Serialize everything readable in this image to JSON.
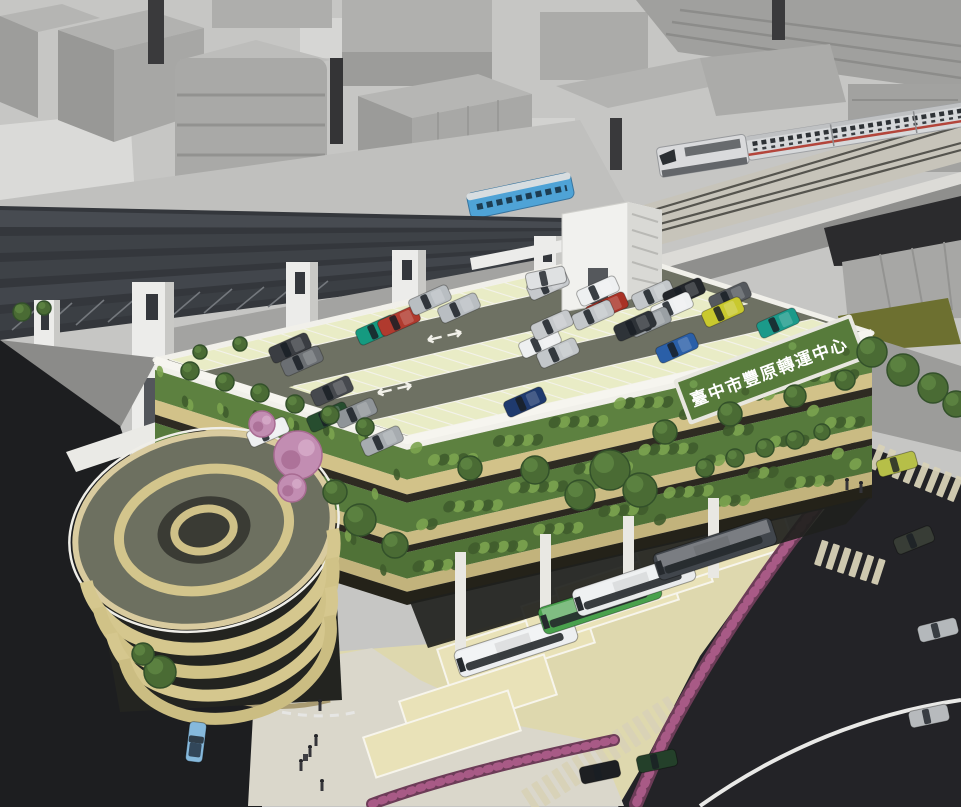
{
  "image": {
    "width": 961,
    "height": 807,
    "kind": "architectural-aerial-rendering",
    "subject": "transit-center-parking-building"
  },
  "sign": {
    "text": "臺中市豐原轉運中心",
    "text_color": "#ffffff",
    "panel_color": "#577b3b",
    "frame_color": "#e8e7e0"
  },
  "palette": {
    "city_block": "#b3b3b1",
    "canopy_roof": "#3e4247",
    "pylon": "#ececea",
    "ballast": "#c7c4ba",
    "intercity_train_body": "#d6d8da",
    "intercity_train_stripe": "#b3453b",
    "commuter_train_body": "#4fa3d6",
    "deck": "#6e7163",
    "deck_stall": "#e9ecc6",
    "parapet": "#f1f0ea",
    "bamboo_screen": "#d2c289",
    "foliage": "#5d8140",
    "bus_apron": "#ded8ae",
    "road": "#232327",
    "road_line": "#e9e9e7",
    "sidewalk": "#dad7cb",
    "hedge": "#6d3c58",
    "hedge_flower": "#a85a86",
    "ramp_band": "#d5c78e"
  },
  "deck": {
    "bands": [
      {
        "y0": 0.02,
        "y1": 0.16,
        "x0": 0.02,
        "x1": 0.98,
        "step": 0.048
      },
      {
        "y0": 0.42,
        "y1": 0.58,
        "x0": 0.07,
        "x1": 0.96,
        "step": 0.05
      },
      {
        "y0": 0.8,
        "y1": 0.97,
        "x0": 0.02,
        "x1": 0.98,
        "step": 0.048
      }
    ]
  },
  "facade": {
    "dot_bands": [
      [
        0.06,
        0.24
      ],
      [
        0.38,
        0.56
      ],
      [
        0.68,
        0.84
      ]
    ],
    "front_dots": 120,
    "left_dots": 40,
    "leaf_dark": "#3f5c2c",
    "leaf_light": "#7ba34f"
  },
  "car_angle": -24,
  "roof_cars": [
    [
      548,
      285,
      "#c6c9cc"
    ],
    [
      598,
      291,
      "#eef0f1"
    ],
    [
      653,
      295,
      "#c3c7ca"
    ],
    [
      684,
      293,
      "#23262b"
    ],
    [
      730,
      297,
      "#55595e"
    ],
    [
      607,
      307,
      "#a93226"
    ],
    [
      593,
      315,
      "#c3c7ca"
    ],
    [
      672,
      307,
      "#eef0f1"
    ],
    [
      723,
      312,
      "#c9c92e"
    ],
    [
      778,
      323,
      "#1b9a8a"
    ],
    [
      650,
      322,
      "#9aa0a4"
    ],
    [
      635,
      326,
      "#2e3338"
    ],
    [
      377,
      330,
      "#159a80"
    ],
    [
      399,
      321,
      "#b03a2e"
    ],
    [
      459,
      308,
      "#b9bec2"
    ],
    [
      540,
      343,
      "#eef0f1"
    ],
    [
      558,
      353,
      "#c3c7ca"
    ],
    [
      290,
      348,
      "#3a3d42"
    ],
    [
      552,
      325,
      "#c6c9cc"
    ],
    [
      677,
      348,
      "#2a5fa8"
    ],
    [
      332,
      391,
      "#46494e"
    ],
    [
      328,
      417,
      "#274d2f"
    ],
    [
      356,
      413,
      "#8f9498"
    ],
    [
      268,
      432,
      "#eef0f1"
    ],
    [
      525,
      402,
      "#1f3a6e"
    ],
    [
      382,
      441,
      "#a7acb0"
    ],
    [
      302,
      361,
      "#6b6f73"
    ],
    [
      430,
      300,
      "#b9bec2"
    ]
  ],
  "bus_angle": -18,
  "buses": [
    {
      "x": 516,
      "y": 646,
      "c": "#edeff1"
    },
    {
      "x": 600,
      "y": 603,
      "c": "#49a14d"
    },
    {
      "x": 634,
      "y": 585,
      "c": "#e9ebec"
    },
    {
      "x": 715,
      "y": 549,
      "c": "#41464c"
    }
  ],
  "empty_stalls": [
    {
      "x": 478,
      "y": 698
    },
    {
      "x": 442,
      "y": 734
    }
  ],
  "street_cars": [
    {
      "x": 196,
      "y": 742,
      "c": "#86b9dc",
      "a": 97,
      "open": true
    },
    {
      "x": 546,
      "y": 278,
      "c": "#dfe1e2",
      "a": -12
    },
    {
      "x": 897,
      "y": 464,
      "c": "#b6bf48",
      "a": -16
    },
    {
      "x": 914,
      "y": 540,
      "c": "#383d36",
      "a": -22
    },
    {
      "x": 938,
      "y": 630,
      "c": "#b4b8bb",
      "a": -14
    },
    {
      "x": 657,
      "y": 761,
      "c": "#24402a",
      "a": -12
    },
    {
      "x": 600,
      "y": 772,
      "c": "#1d1f22",
      "a": -12
    },
    {
      "x": 929,
      "y": 716,
      "c": "#b7babd",
      "a": -12
    }
  ],
  "pedestrians": [
    {
      "x": 320,
      "y": 706
    },
    {
      "x": 316,
      "y": 741
    },
    {
      "x": 310,
      "y": 752,
      "lug": true
    },
    {
      "x": 301,
      "y": 766
    },
    {
      "x": 322,
      "y": 786
    },
    {
      "x": 847,
      "y": 485
    },
    {
      "x": 861,
      "y": 488
    }
  ],
  "tree_color": "#4a6b34",
  "trees": [
    [
      872,
      352,
      15
    ],
    [
      903,
      370,
      16
    ],
    [
      933,
      388,
      15
    ],
    [
      956,
      404,
      13
    ],
    [
      160,
      672,
      16
    ],
    [
      143,
      654,
      11
    ],
    [
      22,
      312,
      9
    ],
    [
      44,
      308,
      7
    ],
    [
      190,
      371,
      9
    ],
    [
      225,
      382,
      9
    ],
    [
      260,
      393,
      9
    ],
    [
      295,
      404,
      9
    ],
    [
      330,
      415,
      9
    ],
    [
      365,
      427,
      9
    ],
    [
      200,
      352,
      7
    ],
    [
      240,
      344,
      7
    ],
    [
      470,
      468,
      12
    ],
    [
      535,
      470,
      14
    ],
    [
      610,
      470,
      20
    ],
    [
      640,
      490,
      17
    ],
    [
      580,
      495,
      15
    ],
    [
      665,
      432,
      12
    ],
    [
      730,
      414,
      12
    ],
    [
      795,
      396,
      11
    ],
    [
      845,
      380,
      10
    ],
    [
      360,
      520,
      16
    ],
    [
      395,
      545,
      13
    ],
    [
      335,
      492,
      12
    ],
    [
      705,
      468,
      9
    ],
    [
      735,
      458,
      9
    ],
    [
      765,
      448,
      9
    ],
    [
      795,
      440,
      9
    ],
    [
      822,
      432,
      8
    ]
  ],
  "pink_trees": [
    [
      298,
      455,
      24
    ],
    [
      262,
      424,
      13
    ],
    [
      292,
      488,
      14
    ]
  ],
  "crosswalks": [
    {
      "x": 874,
      "y": 456,
      "r": 22,
      "n": 8
    },
    {
      "x": 818,
      "y": 552,
      "r": 18,
      "n": 6
    },
    {
      "x": 528,
      "y": 802,
      "r": -33,
      "n": 15
    }
  ]
}
